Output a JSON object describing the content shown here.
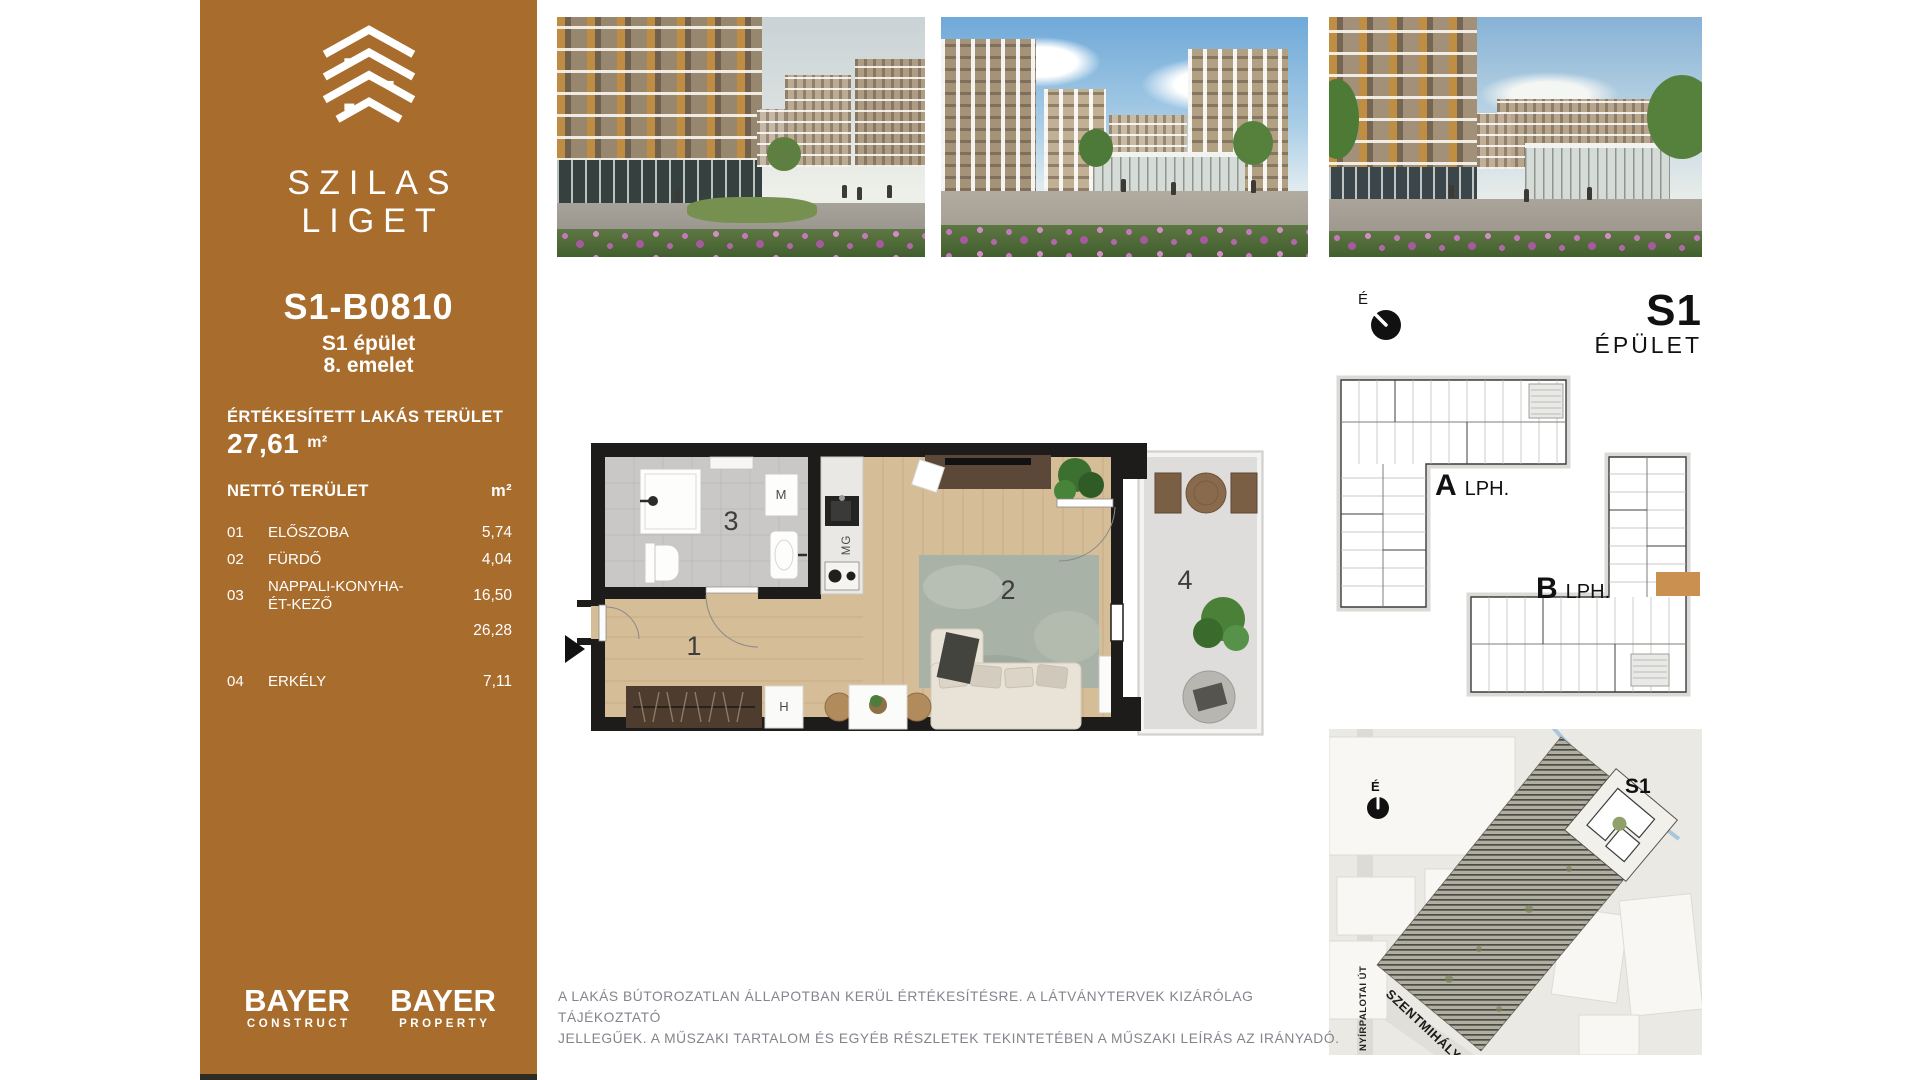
{
  "colors": {
    "sidebar_bg": "#a86c2d",
    "highlight_unit": "#c9904f",
    "plan_wall": "#1d1c1a",
    "disclaimer_text": "#84848c"
  },
  "sidebar": {
    "brand_line1": "SZILAS",
    "brand_line2": "LIGET",
    "unit_id": "S1-B0810",
    "building": "S1 épület",
    "floor": "8. emelet",
    "sold_area_label": "ÉRTÉKESÍTETT LAKÁS TERÜLET",
    "sold_area_value": "27,61",
    "sold_area_unit": "m²",
    "net_area_label": "NETTÓ TERÜLET",
    "net_area_unit": "m²",
    "rooms": [
      {
        "num": "01",
        "name": "ELŐSZOBA",
        "area": "5,74"
      },
      {
        "num": "02",
        "name": "FÜRDŐ",
        "area": "4,04"
      },
      {
        "num": "03",
        "name": "NAPPALI-KONYHA-ÉT-KEZŐ",
        "area": "16,50"
      },
      {
        "num": "",
        "name": "",
        "area": "26,28"
      },
      {
        "num": "04",
        "name": "ERKÉLY",
        "area": "7,11"
      }
    ],
    "logo_construct": {
      "title": "BAYER",
      "subtitle": "CONSTRUCT"
    },
    "logo_property": {
      "title": "BAYER",
      "subtitle": "PROPERTY"
    }
  },
  "floor_plan": {
    "room_numbers": {
      "hall": "1",
      "living": "2",
      "bathroom": "3",
      "balcony": "4"
    },
    "fixtures": {
      "washing_machine": "M",
      "dishwasher": "MG",
      "cabinet": "H"
    }
  },
  "building_diagram": {
    "title": "S1",
    "subtitle": "ÉPÜLET",
    "compass": "É",
    "stair_a": "A",
    "stair_a_suffix": "LPH.",
    "stair_b": "B",
    "stair_b_suffix": "LPH."
  },
  "site_map": {
    "compass": "É",
    "marker": "S1",
    "street_vertical": "NYÍRPALOTAI ÚT",
    "street_diagonal": "SZENTMIHÁLYI ÚT"
  },
  "disclaimer": {
    "line1": "A LAKÁS BÚTOROZATLAN ÁLLAPOTBAN KERÜL ÉRTÉKESÍTÉSRE. A LÁTVÁNYTERVEK KIZÁRÓLAG TÁJÉKOZTATÓ",
    "line2": "JELLEGŰEK. A MŰSZAKI TARTALOM ÉS EGYÉB RÉSZLETEK TEKINTETÉBEN A MŰSZAKI LEÍRÁS AZ IRÁNYADÓ."
  }
}
